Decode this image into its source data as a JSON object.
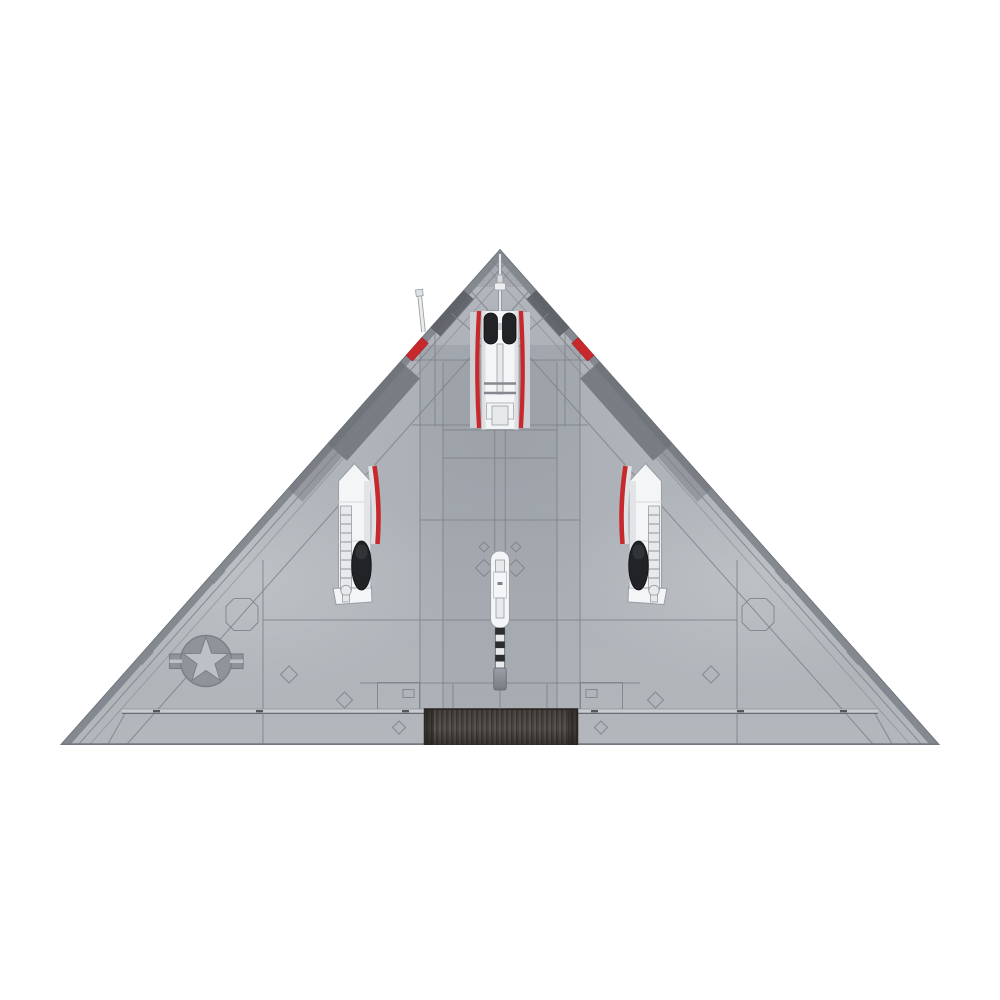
{
  "scene": {
    "type": "product-render on white background",
    "subject": "Delta-wing stealth aircraft, ventral (bottom) view with landing gear extended",
    "orientation": "nose pointing up, pure triangle planform",
    "visible_parts": [
      "nose landing gear bay with twin wheels and red door edges",
      "left main landing gear bay with single wheel and red door edge",
      "right main landing gear bay with single wheel and red door edge",
      "center tail-hook bay with black-and-white striped boom",
      "dark slotted exhaust grille at trailing edge center",
      "low-visibility US star-and-bars insignia on left wing",
      "pitot probe on left leading edge",
      "red leading-edge markers",
      "octagonal and diamond access panels",
      "elevon hinge line along trailing edge"
    ],
    "insignia_symbol": "star-in-circle with side bars"
  },
  "colors": {
    "bg": "#ffffff",
    "bodyBase": "#b2b6bc",
    "line": "#7c8187",
    "edgeBand": "#82868d",
    "edgeOutline": "#6d7177",
    "edgeDark": "#5c5f66",
    "edgeDark2": "#6b6f76",
    "red": "#c7282b",
    "redDark": "#8f1f22",
    "bayFill": "#f4f5f7",
    "bayLine": "#9aa0a6",
    "bayShade": "#dfe2e5",
    "strut": "#e7e9ea",
    "strutLine": "#989da3",
    "wheel": "#222326",
    "wheelDark": "#0e0f11",
    "grilleBase": "#4b4642",
    "grilleLight": "#5a5450",
    "grilleDark": "#332f2b",
    "grilleBorder": "#2a2623",
    "hingeLight": "#cbced2",
    "hingeDark": "#696d73",
    "tick": "#53575c",
    "insigniaMid": "#8f949a",
    "insigniaLight": "#bcc1c7",
    "insigniaLine": "#7a7f86",
    "boomDark": "#2c2d30",
    "boomLight": "#e8eaeb"
  }
}
